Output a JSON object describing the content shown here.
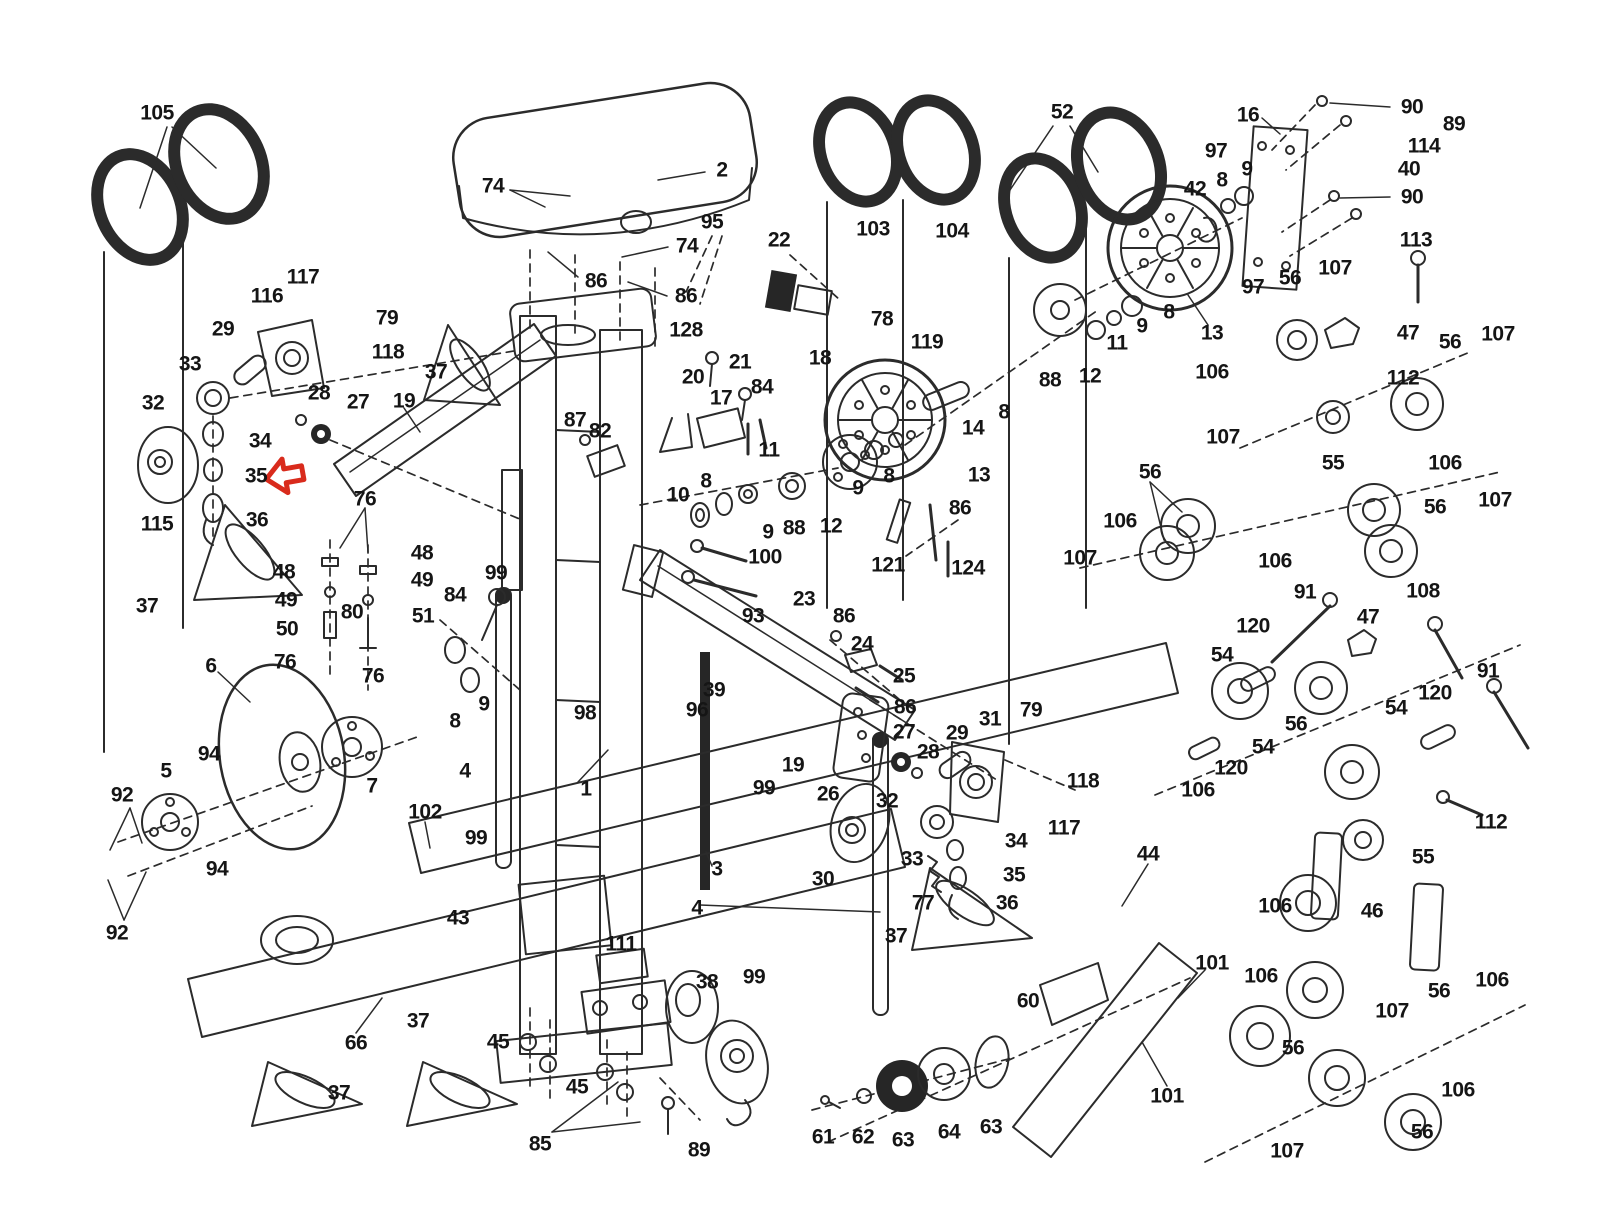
{
  "figure": {
    "type": "exploded-parts-diagram",
    "description": "Exercise machine exploded assembly diagram with numbered part callouts",
    "background_color": "#ffffff",
    "line_color": "#2b2b2b",
    "label_color": "#151515",
    "highlight_arrow": {
      "shape": "left-pointing-block-arrow",
      "color": "#d92b1c",
      "target_part": "35",
      "x": 284,
      "y": 476
    }
  },
  "callouts": [
    {
      "n": "105",
      "x": 157,
      "y": 113
    },
    {
      "n": "2",
      "x": 722,
      "y": 170
    },
    {
      "n": "74",
      "x": 493,
      "y": 186
    },
    {
      "n": "74",
      "x": 687,
      "y": 246
    },
    {
      "n": "86",
      "x": 596,
      "y": 281
    },
    {
      "n": "86",
      "x": 686,
      "y": 296
    },
    {
      "n": "95",
      "x": 712,
      "y": 222
    },
    {
      "n": "22",
      "x": 779,
      "y": 240
    },
    {
      "n": "128",
      "x": 686,
      "y": 330
    },
    {
      "n": "21",
      "x": 740,
      "y": 362
    },
    {
      "n": "18",
      "x": 820,
      "y": 358
    },
    {
      "n": "20",
      "x": 693,
      "y": 377
    },
    {
      "n": "17",
      "x": 721,
      "y": 398
    },
    {
      "n": "84",
      "x": 762,
      "y": 387
    },
    {
      "n": "52",
      "x": 1062,
      "y": 112
    },
    {
      "n": "103",
      "x": 873,
      "y": 229
    },
    {
      "n": "104",
      "x": 952,
      "y": 231
    },
    {
      "n": "78",
      "x": 882,
      "y": 319
    },
    {
      "n": "16",
      "x": 1248,
      "y": 115
    },
    {
      "n": "90",
      "x": 1412,
      "y": 107
    },
    {
      "n": "89",
      "x": 1454,
      "y": 124
    },
    {
      "n": "114",
      "x": 1424,
      "y": 146
    },
    {
      "n": "40",
      "x": 1409,
      "y": 169
    },
    {
      "n": "97",
      "x": 1216,
      "y": 151
    },
    {
      "n": "9",
      "x": 1247,
      "y": 169
    },
    {
      "n": "8",
      "x": 1222,
      "y": 180
    },
    {
      "n": "42",
      "x": 1195,
      "y": 189
    },
    {
      "n": "90",
      "x": 1412,
      "y": 197
    },
    {
      "n": "113",
      "x": 1416,
      "y": 240
    },
    {
      "n": "107",
      "x": 1335,
      "y": 268
    },
    {
      "n": "56",
      "x": 1290,
      "y": 278
    },
    {
      "n": "97",
      "x": 1253,
      "y": 287
    },
    {
      "n": "13",
      "x": 1212,
      "y": 333
    },
    {
      "n": "8",
      "x": 1169,
      "y": 312
    },
    {
      "n": "47",
      "x": 1408,
      "y": 333
    },
    {
      "n": "56",
      "x": 1450,
      "y": 342
    },
    {
      "n": "107",
      "x": 1498,
      "y": 334
    },
    {
      "n": "106",
      "x": 1212,
      "y": 372
    },
    {
      "n": "112",
      "x": 1403,
      "y": 378
    },
    {
      "n": "117",
      "x": 303,
      "y": 277
    },
    {
      "n": "116",
      "x": 267,
      "y": 296
    },
    {
      "n": "29",
      "x": 223,
      "y": 329
    },
    {
      "n": "79",
      "x": 387,
      "y": 318
    },
    {
      "n": "118",
      "x": 388,
      "y": 352
    },
    {
      "n": "33",
      "x": 190,
      "y": 364
    },
    {
      "n": "37",
      "x": 436,
      "y": 372
    },
    {
      "n": "32",
      "x": 153,
      "y": 403
    },
    {
      "n": "28",
      "x": 319,
      "y": 393
    },
    {
      "n": "27",
      "x": 358,
      "y": 402
    },
    {
      "n": "19",
      "x": 404,
      "y": 401
    },
    {
      "n": "34",
      "x": 260,
      "y": 441
    },
    {
      "n": "35",
      "x": 256,
      "y": 476
    },
    {
      "n": "115",
      "x": 157,
      "y": 524
    },
    {
      "n": "36",
      "x": 257,
      "y": 520
    },
    {
      "n": "37",
      "x": 147,
      "y": 606
    },
    {
      "n": "87",
      "x": 575,
      "y": 420
    },
    {
      "n": "82",
      "x": 600,
      "y": 431
    },
    {
      "n": "119",
      "x": 927,
      "y": 342
    },
    {
      "n": "14",
      "x": 973,
      "y": 428
    },
    {
      "n": "8",
      "x": 1004,
      "y": 412
    },
    {
      "n": "13",
      "x": 979,
      "y": 475
    },
    {
      "n": "11",
      "x": 1117,
      "y": 343
    },
    {
      "n": "9",
      "x": 1142,
      "y": 326
    },
    {
      "n": "12",
      "x": 1090,
      "y": 376
    },
    {
      "n": "88",
      "x": 1050,
      "y": 380
    },
    {
      "n": "10",
      "x": 678,
      "y": 495
    },
    {
      "n": "8",
      "x": 706,
      "y": 481
    },
    {
      "n": "11",
      "x": 769,
      "y": 450
    },
    {
      "n": "9",
      "x": 768,
      "y": 532
    },
    {
      "n": "88",
      "x": 794,
      "y": 528
    },
    {
      "n": "12",
      "x": 831,
      "y": 526
    },
    {
      "n": "9",
      "x": 858,
      "y": 488
    },
    {
      "n": "8",
      "x": 889,
      "y": 476
    },
    {
      "n": "86",
      "x": 960,
      "y": 508
    },
    {
      "n": "121",
      "x": 888,
      "y": 565
    },
    {
      "n": "124",
      "x": 968,
      "y": 568
    },
    {
      "n": "100",
      "x": 765,
      "y": 557
    },
    {
      "n": "93",
      "x": 753,
      "y": 616
    },
    {
      "n": "23",
      "x": 804,
      "y": 599
    },
    {
      "n": "86",
      "x": 844,
      "y": 616
    },
    {
      "n": "24",
      "x": 862,
      "y": 644
    },
    {
      "n": "25",
      "x": 904,
      "y": 676
    },
    {
      "n": "86",
      "x": 905,
      "y": 707
    },
    {
      "n": "19",
      "x": 793,
      "y": 765
    },
    {
      "n": "26",
      "x": 828,
      "y": 794
    },
    {
      "n": "99",
      "x": 764,
      "y": 788
    },
    {
      "n": "56",
      "x": 1150,
      "y": 472
    },
    {
      "n": "107",
      "x": 1223,
      "y": 437
    },
    {
      "n": "55",
      "x": 1333,
      "y": 463
    },
    {
      "n": "106",
      "x": 1445,
      "y": 463
    },
    {
      "n": "106",
      "x": 1120,
      "y": 521
    },
    {
      "n": "107",
      "x": 1080,
      "y": 558
    },
    {
      "n": "56",
      "x": 1435,
      "y": 507
    },
    {
      "n": "107",
      "x": 1495,
      "y": 500
    },
    {
      "n": "106",
      "x": 1275,
      "y": 561
    },
    {
      "n": "91",
      "x": 1305,
      "y": 592
    },
    {
      "n": "108",
      "x": 1423,
      "y": 591
    },
    {
      "n": "120",
      "x": 1253,
      "y": 626
    },
    {
      "n": "47",
      "x": 1368,
      "y": 617
    },
    {
      "n": "54",
      "x": 1222,
      "y": 655
    },
    {
      "n": "91",
      "x": 1488,
      "y": 671
    },
    {
      "n": "120",
      "x": 1435,
      "y": 693
    },
    {
      "n": "54",
      "x": 1396,
      "y": 708
    },
    {
      "n": "56",
      "x": 1296,
      "y": 724
    },
    {
      "n": "54",
      "x": 1263,
      "y": 747
    },
    {
      "n": "120",
      "x": 1231,
      "y": 768
    },
    {
      "n": "106",
      "x": 1198,
      "y": 790
    },
    {
      "n": "112",
      "x": 1491,
      "y": 822
    },
    {
      "n": "55",
      "x": 1423,
      "y": 857
    },
    {
      "n": "46",
      "x": 1372,
      "y": 911
    },
    {
      "n": "106",
      "x": 1275,
      "y": 906
    },
    {
      "n": "48",
      "x": 284,
      "y": 572
    },
    {
      "n": "49",
      "x": 286,
      "y": 600
    },
    {
      "n": "50",
      "x": 287,
      "y": 629
    },
    {
      "n": "76",
      "x": 365,
      "y": 499
    },
    {
      "n": "76",
      "x": 285,
      "y": 662
    },
    {
      "n": "76",
      "x": 373,
      "y": 676
    },
    {
      "n": "48",
      "x": 422,
      "y": 553
    },
    {
      "n": "49",
      "x": 422,
      "y": 580
    },
    {
      "n": "84",
      "x": 455,
      "y": 595
    },
    {
      "n": "80",
      "x": 352,
      "y": 612
    },
    {
      "n": "51",
      "x": 423,
      "y": 616
    },
    {
      "n": "99",
      "x": 496,
      "y": 573
    },
    {
      "n": "6",
      "x": 211,
      "y": 666
    },
    {
      "n": "98",
      "x": 585,
      "y": 713
    },
    {
      "n": "9",
      "x": 484,
      "y": 704
    },
    {
      "n": "8",
      "x": 455,
      "y": 721
    },
    {
      "n": "96",
      "x": 697,
      "y": 710
    },
    {
      "n": "39",
      "x": 714,
      "y": 690
    },
    {
      "n": "4",
      "x": 465,
      "y": 771
    },
    {
      "n": "1",
      "x": 586,
      "y": 789
    },
    {
      "n": "94",
      "x": 209,
      "y": 754
    },
    {
      "n": "5",
      "x": 166,
      "y": 771
    },
    {
      "n": "92",
      "x": 122,
      "y": 795
    },
    {
      "n": "7",
      "x": 372,
      "y": 786
    },
    {
      "n": "94",
      "x": 217,
      "y": 869
    },
    {
      "n": "92",
      "x": 117,
      "y": 933
    },
    {
      "n": "102",
      "x": 425,
      "y": 812
    },
    {
      "n": "99",
      "x": 476,
      "y": 838
    },
    {
      "n": "3",
      "x": 717,
      "y": 869
    },
    {
      "n": "4",
      "x": 697,
      "y": 908
    },
    {
      "n": "43",
      "x": 458,
      "y": 918
    },
    {
      "n": "111",
      "x": 621,
      "y": 944
    },
    {
      "n": "38",
      "x": 707,
      "y": 982
    },
    {
      "n": "99",
      "x": 754,
      "y": 977
    },
    {
      "n": "30",
      "x": 823,
      "y": 879
    },
    {
      "n": "32",
      "x": 887,
      "y": 801
    },
    {
      "n": "33",
      "x": 912,
      "y": 859
    },
    {
      "n": "27",
      "x": 904,
      "y": 732
    },
    {
      "n": "28",
      "x": 928,
      "y": 752
    },
    {
      "n": "29",
      "x": 957,
      "y": 733
    },
    {
      "n": "31",
      "x": 990,
      "y": 719
    },
    {
      "n": "79",
      "x": 1031,
      "y": 710
    },
    {
      "n": "118",
      "x": 1083,
      "y": 781
    },
    {
      "n": "117",
      "x": 1064,
      "y": 828
    },
    {
      "n": "34",
      "x": 1016,
      "y": 841
    },
    {
      "n": "35",
      "x": 1014,
      "y": 875
    },
    {
      "n": "36",
      "x": 1007,
      "y": 903
    },
    {
      "n": "77",
      "x": 923,
      "y": 903
    },
    {
      "n": "37",
      "x": 896,
      "y": 936
    },
    {
      "n": "44",
      "x": 1148,
      "y": 854
    },
    {
      "n": "60",
      "x": 1028,
      "y": 1001
    },
    {
      "n": "101",
      "x": 1212,
      "y": 963
    },
    {
      "n": "101",
      "x": 1167,
      "y": 1096
    },
    {
      "n": "66",
      "x": 356,
      "y": 1043
    },
    {
      "n": "37",
      "x": 418,
      "y": 1021
    },
    {
      "n": "37",
      "x": 339,
      "y": 1093
    },
    {
      "n": "45",
      "x": 498,
      "y": 1042
    },
    {
      "n": "45",
      "x": 577,
      "y": 1087
    },
    {
      "n": "85",
      "x": 540,
      "y": 1144
    },
    {
      "n": "89",
      "x": 699,
      "y": 1150
    },
    {
      "n": "61",
      "x": 823,
      "y": 1137
    },
    {
      "n": "62",
      "x": 863,
      "y": 1137
    },
    {
      "n": "63",
      "x": 903,
      "y": 1140
    },
    {
      "n": "64",
      "x": 949,
      "y": 1132
    },
    {
      "n": "63",
      "x": 991,
      "y": 1127
    },
    {
      "n": "106",
      "x": 1261,
      "y": 976
    },
    {
      "n": "106",
      "x": 1492,
      "y": 980
    },
    {
      "n": "56",
      "x": 1439,
      "y": 991
    },
    {
      "n": "107",
      "x": 1392,
      "y": 1011
    },
    {
      "n": "56",
      "x": 1293,
      "y": 1048
    },
    {
      "n": "106",
      "x": 1458,
      "y": 1090
    },
    {
      "n": "56",
      "x": 1422,
      "y": 1132
    },
    {
      "n": "107",
      "x": 1287,
      "y": 1151
    }
  ]
}
